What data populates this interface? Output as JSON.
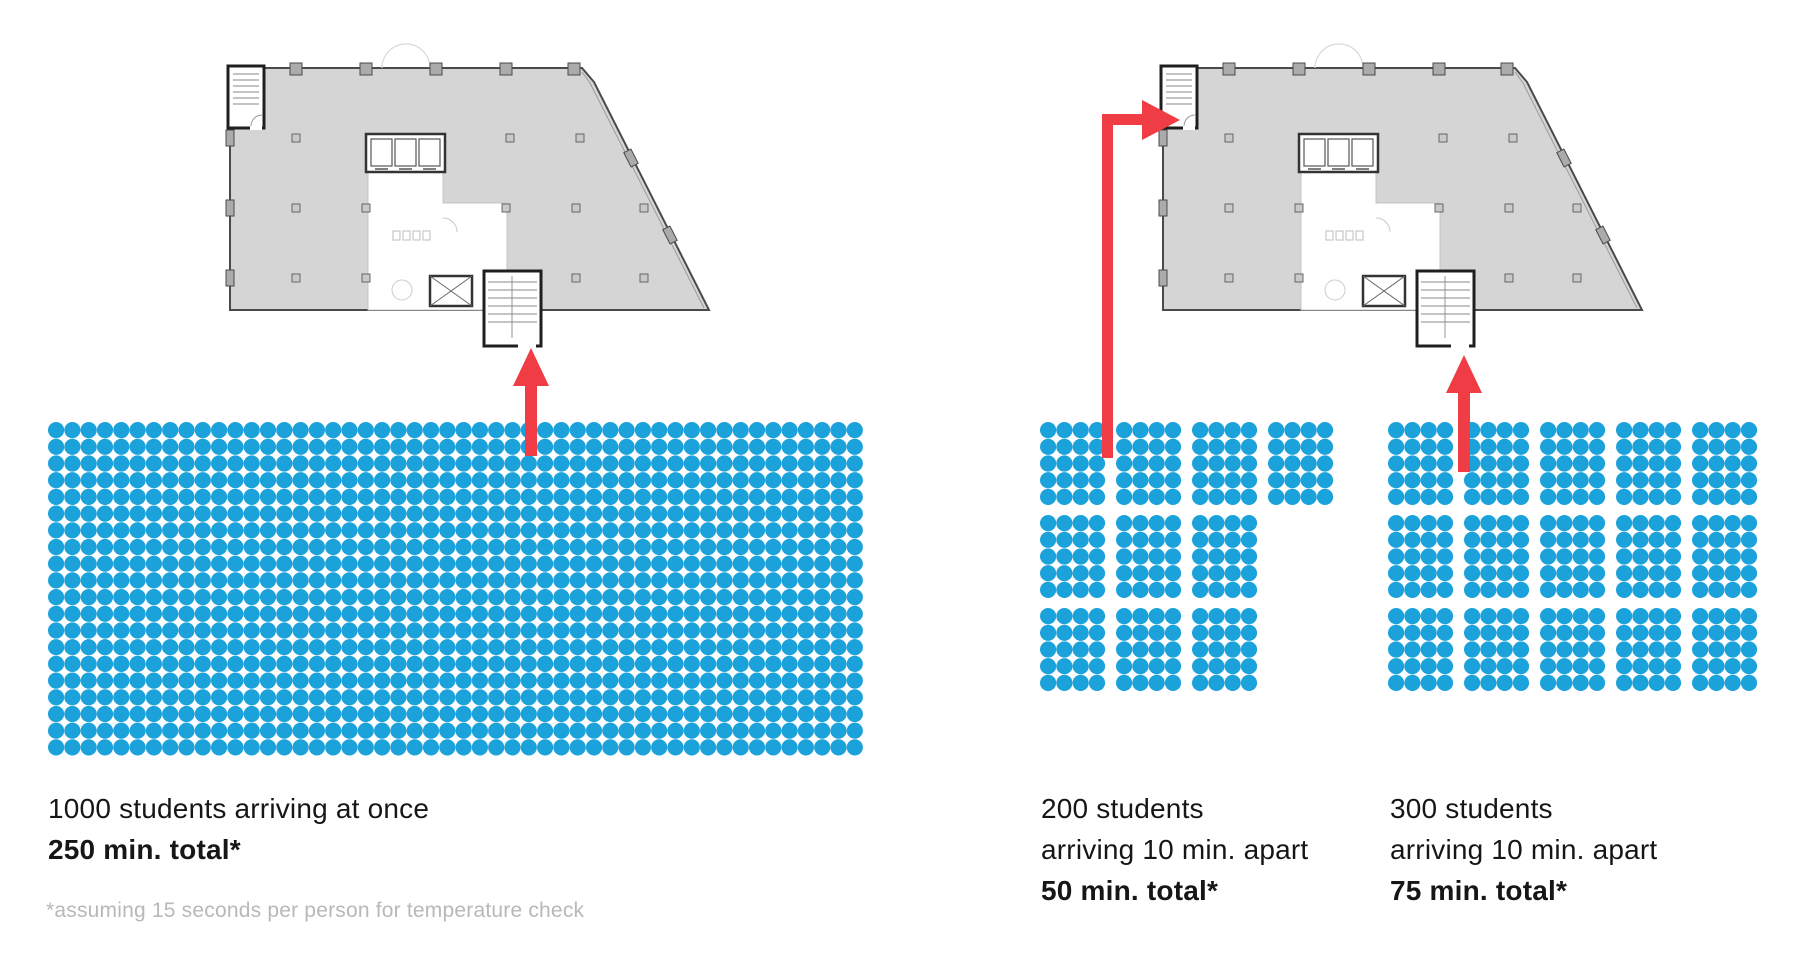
{
  "colors": {
    "dot_blue": "#1CA2DB",
    "arrow_red": "#EF3C45",
    "plan_fill": "#D5D5D5",
    "plan_wall": "#4A4A4A",
    "text_black": "#161616",
    "footnote_gray": "#B8B8B8"
  },
  "scenario_left": {
    "line1": "1000 students arriving at once",
    "line2": "250 min. total*"
  },
  "scenario_middle": {
    "line1": "200 students",
    "line2": "arriving 10 min. apart",
    "line3": "50 min. total*"
  },
  "scenario_right": {
    "line1": "300 students",
    "line2": "arriving 10 min. apart",
    "line3": "75 min. total*"
  },
  "footnote": "*assuming 15 seconds per person for temperature check",
  "chart_data": {
    "type": "pictograph",
    "groups": [
      {
        "id": "all-at-once",
        "students": 1000,
        "arrival": "arriving at once",
        "minutes_total": 250,
        "dot_layout": {
          "kind": "grid",
          "cols": 50,
          "rows": 20
        }
      },
      {
        "id": "staggered-200",
        "students": 200,
        "arrival": "arriving 10 min. apart",
        "minutes_total": 50,
        "dot_layout": {
          "kind": "blocks",
          "block_cols": 4,
          "block_rows": 5,
          "blocks_per_row": [
            4,
            3,
            3
          ]
        }
      },
      {
        "id": "staggered-300",
        "students": 300,
        "arrival": "arriving 10 min. apart",
        "minutes_total": 75,
        "dot_layout": {
          "kind": "blocks",
          "block_cols": 4,
          "block_rows": 5,
          "blocks_per_row": [
            5,
            5,
            5
          ]
        }
      }
    ]
  }
}
